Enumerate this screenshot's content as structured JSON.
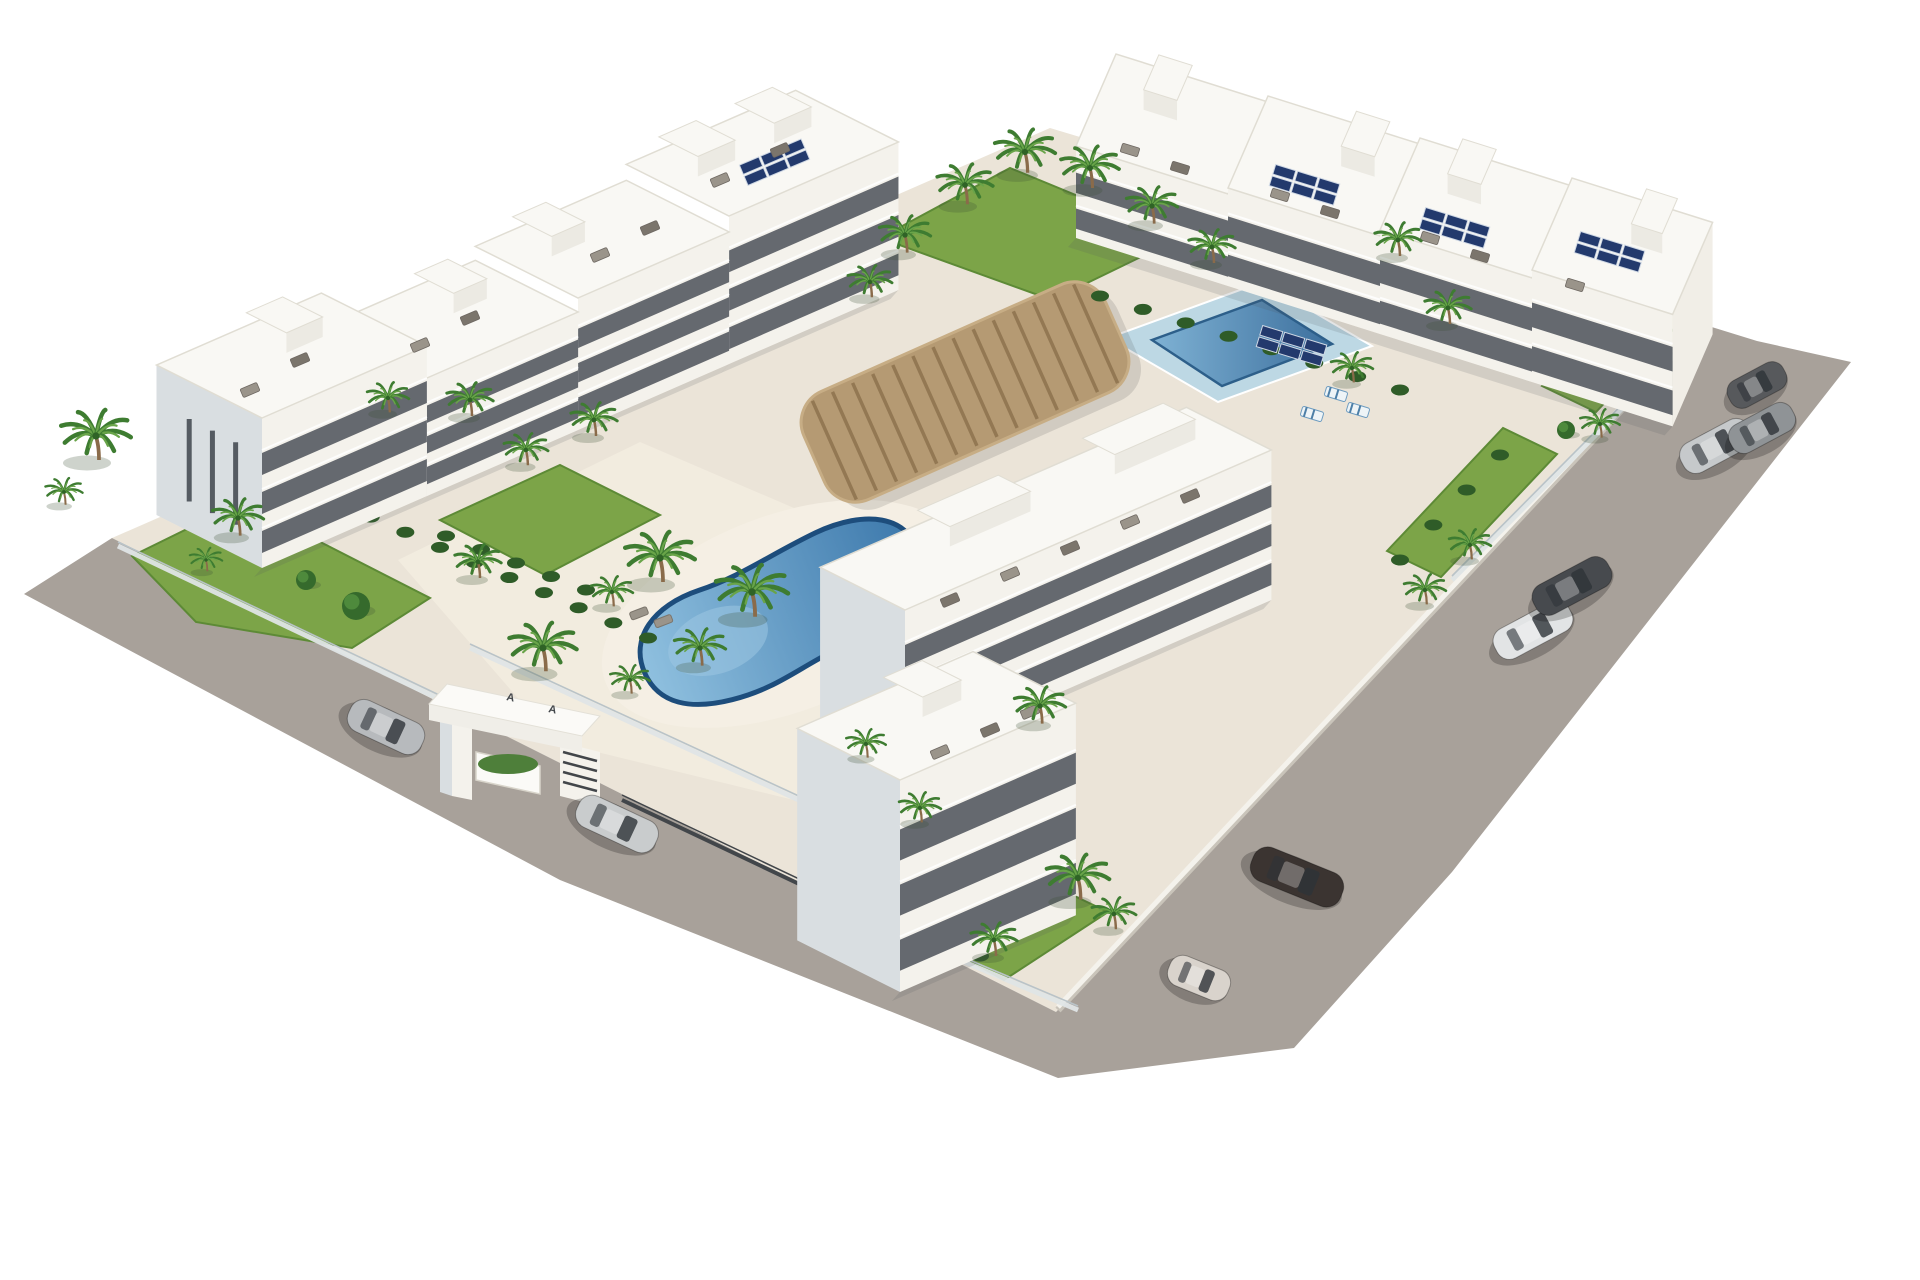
{
  "meta": {
    "title": "Aerial 3D render of white apartment complex with pools",
    "canvas_w": 1920,
    "canvas_h": 1280,
    "background": "#ffffff"
  },
  "palette": {
    "road": "#a8a19a",
    "plot": "#ebe4d8",
    "courtyard": "#f2ecdf",
    "pooldeck": "#f5efe4",
    "roof": "#f9f8f4",
    "roof_edge": "#e0ddd3",
    "front": "#f4f2ec",
    "side": "#d9dee1",
    "side_bright": "#f1eee7",
    "window": "#454b53",
    "ledge": "#ffffff",
    "grass": "#7ca448",
    "grass_dark": "#5d8a36",
    "hedge": "#2f5c28",
    "palm_green": "#3e7c31",
    "palm_light": "#69a449",
    "trunk": "#8a6b4a",
    "pool_rim": "#1d4d7c",
    "pool_light": "#9cc6e2",
    "pool_deep": "#366f9f",
    "lap_deck": "#bdd8e4",
    "lap_rim": "#2d5f8a",
    "wood": "#b59a73",
    "wood_dark": "#937853",
    "wood_light": "#c7ad85",
    "fence_glass": "#dfe5e6",
    "fence_cap": "#b9c3c8",
    "fence_dark": "#42464a",
    "solar": "#233a6d",
    "solar_frame": "#cfd8e4",
    "furniture_a": "#9a948a",
    "furniture_b": "#7b756c",
    "shadow": "rgba(80,85,95,0.16)",
    "wall_white": "#f4f2ec",
    "wall_shadow": "#c9c4ba"
  },
  "entrance": {
    "logo_marks": [
      "A",
      "A"
    ],
    "logo_pos": [
      [
        506,
        700
      ],
      [
        548,
        712
      ]
    ],
    "beam_top": [
      [
        447,
        684
      ],
      [
        600,
        716
      ],
      [
        582,
        736
      ],
      [
        429,
        704
      ]
    ],
    "beam_front": [
      [
        429,
        704
      ],
      [
        582,
        736
      ],
      [
        582,
        752
      ],
      [
        429,
        720
      ]
    ],
    "pillar_front": [
      [
        452,
        716
      ],
      [
        472,
        720
      ],
      [
        472,
        800
      ],
      [
        452,
        796
      ]
    ],
    "pillar_side": [
      [
        440,
        712
      ],
      [
        452,
        716
      ],
      [
        452,
        796
      ],
      [
        440,
        792
      ]
    ],
    "right_wall": [
      [
        560,
        742
      ],
      [
        600,
        752
      ],
      [
        600,
        806
      ],
      [
        560,
        796
      ]
    ],
    "planter": [
      [
        476,
        752
      ],
      [
        540,
        766
      ],
      [
        540,
        794
      ],
      [
        476,
        780
      ]
    ],
    "slat_lines": [
      [
        [
          563,
          752
        ],
        [
          597,
          761
        ]
      ],
      [
        [
          563,
          762
        ],
        [
          597,
          771
        ]
      ],
      [
        [
          563,
          772
        ],
        [
          597,
          781
        ]
      ],
      [
        [
          563,
          782
        ],
        [
          597,
          791
        ]
      ]
    ]
  },
  "scene": {
    "road": {
      "points": [
        [
          24,
          594
        ],
        [
          112,
          538
        ],
        [
          1056,
          1012
        ],
        [
          1702,
          324
        ],
        [
          1757,
          341
        ],
        [
          1851,
          362
        ],
        [
          1452,
          872
        ],
        [
          1294,
          1048
        ],
        [
          1058,
          1078
        ],
        [
          560,
          880
        ]
      ]
    },
    "plot": {
      "points": [
        [
          112,
          538
        ],
        [
          1050,
          128
        ],
        [
          1702,
          324
        ],
        [
          1056,
          1012
        ]
      ]
    },
    "courtyard": {
      "points": [
        [
          398,
          560
        ],
        [
          640,
          442
        ],
        [
          906,
          556
        ],
        [
          1064,
          656
        ],
        [
          884,
          822
        ],
        [
          556,
          742
        ]
      ]
    },
    "boundary_wall": {
      "from": [
        1058,
        1010
      ],
      "to": [
        1700,
        326
      ]
    },
    "gardens": [
      {
        "name": "left-garden",
        "points": [
          [
            132,
            556
          ],
          [
            242,
            502
          ],
          [
            430,
            598
          ],
          [
            352,
            648
          ],
          [
            196,
            622
          ]
        ]
      },
      {
        "name": "bottom-garden",
        "points": [
          [
            800,
            856
          ],
          [
            898,
            812
          ],
          [
            1108,
            912
          ],
          [
            1004,
            980
          ],
          [
            866,
            904
          ]
        ]
      },
      {
        "name": "top-center-lawn",
        "points": [
          [
            880,
            238
          ],
          [
            1010,
            168
          ],
          [
            1180,
            238
          ],
          [
            1052,
            300
          ]
        ]
      },
      {
        "name": "right-garden-strip-a",
        "points": [
          [
            1387,
            551
          ],
          [
            1503,
            428
          ],
          [
            1557,
            454
          ],
          [
            1441,
            577
          ]
        ]
      },
      {
        "name": "right-garden-strip-b",
        "points": [
          [
            1542,
            386
          ],
          [
            1619,
            304
          ],
          [
            1673,
            330
          ],
          [
            1596,
            412
          ]
        ]
      },
      {
        "name": "pool-west-bed",
        "points": [
          [
            440,
            520
          ],
          [
            560,
            465
          ],
          [
            660,
            515
          ],
          [
            545,
            575
          ]
        ]
      }
    ],
    "fences_glass": [
      [
        [
          118,
          546
        ],
        [
          458,
          708
        ]
      ],
      [
        [
          908,
          938
        ],
        [
          1078,
          1010
        ]
      ],
      [
        [
          1452,
          580
        ],
        [
          1700,
          330
        ]
      ],
      [
        [
          470,
          648
        ],
        [
          842,
          820
        ]
      ]
    ],
    "fences_dark": [
      [
        [
          622,
          800
        ],
        [
          892,
          928
        ]
      ]
    ],
    "pool_kidney": {
      "cx": 782,
      "cy": 612,
      "rot": -21,
      "deck_rx": 190,
      "deck_ry": 98,
      "path": "M -150,8 C -152,-30 -118,-52 -70,-50 C -25,-48 10,-58 60,-62 C 115,-66 152,-44 148,-8 C 145,28 108,52 48,54 C 0,56 -28,70 -78,64 C -120,59 -148,42 -150,8 Z",
      "shallow": {
        "cx": -70,
        "cy": 4,
        "rx": 52,
        "ry": 32
      },
      "loungers": [
        [
          648,
          562,
          -21
        ],
        [
          668,
          578,
          -21
        ]
      ],
      "parasol": [
        634,
        548,
        10
      ]
    },
    "pool_lap": {
      "deck": [
        [
          1108,
          338
        ],
        [
          1262,
          282
        ],
        [
          1372,
          346
        ],
        [
          1218,
          402
        ]
      ],
      "inner": [
        [
          1152,
          340
        ],
        [
          1262,
          300
        ],
        [
          1332,
          344
        ],
        [
          1222,
          386
        ]
      ],
      "striped_loungers": [
        [
          1336,
          394,
          17
        ],
        [
          1358,
          410,
          17
        ],
        [
          1312,
          414,
          17
        ]
      ]
    },
    "pergola": {
      "cx": 965,
      "cy": 392,
      "w": 330,
      "h": 118,
      "rot": -24,
      "rx": 34,
      "slats": 15
    },
    "hedge_chains": [
      {
        "from": [
          336,
          502
        ],
        "to": [
          648,
          638
        ],
        "n": 10
      },
      {
        "from": [
          922,
          742
        ],
        "to": [
          1236,
          602
        ],
        "n": 10
      },
      {
        "from": [
          446,
          536
        ],
        "to": [
          586,
          590
        ],
        "n": 5
      },
      {
        "from": [
          1100,
          296
        ],
        "to": [
          1400,
          390
        ],
        "n": 8
      },
      {
        "from": [
          810,
          880
        ],
        "to": [
          980,
          956
        ],
        "n": 5
      },
      {
        "from": [
          1400,
          560
        ],
        "to": [
          1500,
          455
        ],
        "n": 4
      }
    ],
    "trees": [
      [
        356,
        606,
        14
      ],
      [
        306,
        580,
        10
      ],
      [
        886,
        878,
        12
      ],
      [
        948,
        908,
        12
      ],
      [
        1566,
        430,
        9
      ]
    ],
    "axes": {
      "u_left": [
        0.916,
        -0.4
      ],
      "n_left": [
        -0.894,
        -0.449
      ],
      "u_top": [
        0.95,
        0.3
      ],
      "n_top": [
        0.4,
        -0.92
      ]
    },
    "buildings": [
      {
        "name": "left-wing-block-4",
        "o": [
          729,
          364
        ],
        "len": 185,
        "dep": 115,
        "h": 148,
        "floors": 3,
        "dir": "left",
        "end": "none",
        "ph": [
          0.15,
          0.6
        ]
      },
      {
        "name": "left-wing-block-3",
        "o": [
          578,
          430
        ],
        "len": 165,
        "dep": 115,
        "h": 132,
        "floors": 3,
        "dir": "left",
        "end": "none",
        "ph": [
          0.2
        ]
      },
      {
        "name": "left-wing-block-2",
        "o": [
          427,
          496
        ],
        "len": 165,
        "dep": 115,
        "h": 118,
        "floors": 3,
        "dir": "left",
        "end": "none",
        "ph": [
          0.55
        ]
      },
      {
        "name": "left-corner-building",
        "o": [
          262,
          568
        ],
        "len": 180,
        "dep": 118,
        "h": 150,
        "floors": 3,
        "dir": "left",
        "end": "start",
        "sideSlots": 3,
        "ph": [
          0.5
        ]
      },
      {
        "name": "top-wing-block-1",
        "o": [
          1076,
          238
        ],
        "len": 160,
        "dep": 100,
        "h": 92,
        "floors": 2,
        "dir": "top",
        "end": "none",
        "ph": [
          0.3
        ]
      },
      {
        "name": "top-wing-block-2",
        "o": [
          1228,
          286
        ],
        "len": 160,
        "dep": 100,
        "h": 98,
        "floors": 2,
        "dir": "top",
        "end": "none",
        "ph": [
          0.6
        ]
      },
      {
        "name": "top-wing-block-3",
        "o": [
          1380,
          334
        ],
        "len": 160,
        "dep": 100,
        "h": 104,
        "floors": 2,
        "dir": "top",
        "end": "none",
        "ph": [
          0.3
        ]
      },
      {
        "name": "top-wing-block-4",
        "o": [
          1532,
          382
        ],
        "len": 148,
        "dep": 100,
        "h": 112,
        "floors": 2,
        "dir": "top",
        "end": "end",
        "ph": [
          0.55
        ]
      },
      {
        "name": "middle-building",
        "o": [
          905,
          760
        ],
        "len": 400,
        "dep": 95,
        "h": 150,
        "floors": 3,
        "dir": "left",
        "end": "start",
        "ph": [
          0.25,
          0.7
        ]
      },
      {
        "name": "bottom-corner-building",
        "o": [
          900,
          992
        ],
        "len": 192,
        "dep": 115,
        "h": 212,
        "floors": 3,
        "dir": "left",
        "end": "start",
        "ph": [
          0.45
        ]
      }
    ],
    "solar_arrays": [
      [
        775,
        162,
        -23
      ],
      [
        1305,
        185,
        17
      ],
      [
        1455,
        228,
        17
      ],
      [
        1610,
        252,
        17
      ],
      [
        1292,
        346,
        17
      ]
    ],
    "roof_furniture": [
      [
        250,
        390,
        -23,
        0
      ],
      [
        300,
        360,
        -23,
        1
      ],
      [
        420,
        345,
        -23,
        0
      ],
      [
        470,
        318,
        -23,
        1
      ],
      [
        600,
        255,
        -23,
        0
      ],
      [
        650,
        228,
        -23,
        1
      ],
      [
        720,
        180,
        -23,
        0
      ],
      [
        780,
        150,
        -23,
        1
      ],
      [
        1130,
        150,
        17,
        0
      ],
      [
        1180,
        168,
        17,
        1
      ],
      [
        1280,
        195,
        17,
        0
      ],
      [
        1330,
        212,
        17,
        1
      ],
      [
        1430,
        238,
        17,
        0
      ],
      [
        1480,
        256,
        17,
        1
      ],
      [
        1575,
        285,
        17,
        0
      ],
      [
        950,
        600,
        -23,
        1
      ],
      [
        1010,
        574,
        -23,
        0
      ],
      [
        1070,
        548,
        -23,
        1
      ],
      [
        1130,
        522,
        -23,
        0
      ],
      [
        1190,
        496,
        -23,
        1
      ],
      [
        940,
        752,
        -23,
        0
      ],
      [
        990,
        730,
        -23,
        1
      ],
      [
        1030,
        712,
        -23,
        0
      ]
    ],
    "palms": [
      [
        96,
        436,
        1.5
      ],
      [
        64,
        492,
        0.8
      ],
      [
        238,
        518,
        1.1
      ],
      [
        206,
        560,
        0.7
      ],
      [
        388,
        398,
        0.9
      ],
      [
        470,
        400,
        1.0
      ],
      [
        526,
        450,
        0.95
      ],
      [
        594,
        420,
        1.0
      ],
      [
        478,
        562,
        1.0
      ],
      [
        543,
        648,
        1.45
      ],
      [
        612,
        592,
        0.9
      ],
      [
        660,
        558,
        1.5
      ],
      [
        752,
        592,
        1.55
      ],
      [
        700,
        648,
        1.1
      ],
      [
        630,
        680,
        0.85
      ],
      [
        870,
        282,
        0.95
      ],
      [
        905,
        235,
        1.1
      ],
      [
        965,
        185,
        1.2
      ],
      [
        1025,
        152,
        1.3
      ],
      [
        1090,
        168,
        1.25
      ],
      [
        1152,
        206,
        1.1
      ],
      [
        1212,
        247,
        1.0
      ],
      [
        1398,
        240,
        1.0
      ],
      [
        1448,
        308,
        1.0
      ],
      [
        1352,
        368,
        0.9
      ],
      [
        1470,
        545,
        0.9
      ],
      [
        1425,
        590,
        0.9
      ],
      [
        1600,
        424,
        0.85
      ],
      [
        1040,
        706,
        1.1
      ],
      [
        866,
        744,
        0.85
      ],
      [
        920,
        808,
        0.9
      ],
      [
        1078,
        878,
        1.35
      ],
      [
        994,
        940,
        1.0
      ],
      [
        1114,
        914,
        0.95
      ]
    ],
    "cars": [
      {
        "x": 386,
        "y": 727,
        "rot": 25,
        "c": "#b7babd",
        "L": 80,
        "W": 34
      },
      {
        "x": 617,
        "y": 824,
        "rot": 25,
        "c": "#c9cccd",
        "L": 86,
        "W": 34
      },
      {
        "x": 1199,
        "y": 978,
        "rot": 22,
        "c": "#d9d3cc",
        "L": 64,
        "W": 32
      },
      {
        "x": 1297,
        "y": 877,
        "rot": 22,
        "c": "#3b3431",
        "L": 96,
        "W": 36
      },
      {
        "x": 1533,
        "y": 630,
        "rot": -28,
        "c": "#e2e4e5",
        "L": 84,
        "W": 33
      },
      {
        "x": 1572,
        "y": 586,
        "rot": -28,
        "c": "#474a4e",
        "L": 84,
        "W": 33
      },
      {
        "x": 1716,
        "y": 446,
        "rot": -28,
        "c": "#c6c9cb",
        "L": 76,
        "W": 33
      },
      {
        "x": 1762,
        "y": 428,
        "rot": -28,
        "c": "#8f9396",
        "L": 70,
        "W": 31
      },
      {
        "x": 1757,
        "y": 385,
        "rot": -28,
        "c": "#57595c",
        "L": 62,
        "W": 30
      }
    ]
  }
}
